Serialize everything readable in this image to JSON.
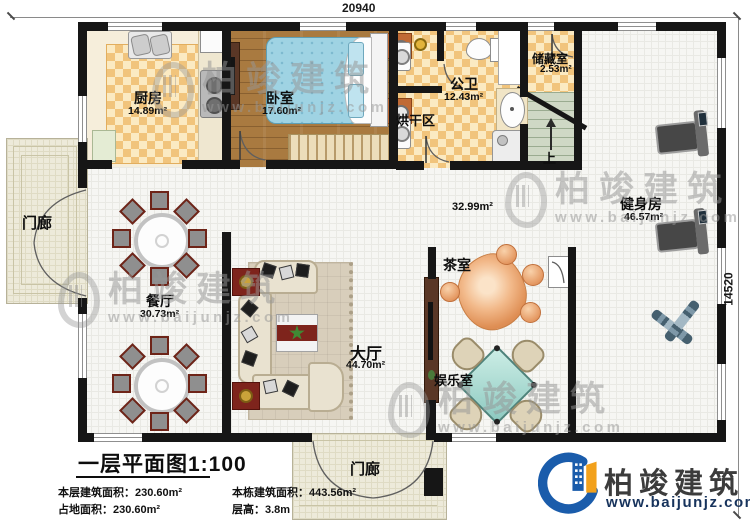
{
  "dimensions": {
    "top": "20940",
    "right": "14520"
  },
  "rooms": {
    "kitchen": {
      "label": "厨房",
      "area": "14.89m²"
    },
    "bedroom": {
      "label": "卧室",
      "area": "17.60m²"
    },
    "bathroom": {
      "label": "公卫",
      "area": "12.43m²"
    },
    "storage": {
      "label": "储藏室",
      "area": "2.53m²"
    },
    "drying": {
      "label": "烘干区"
    },
    "stairs": {
      "label": "上"
    },
    "gym": {
      "label": "健身房",
      "area": "46.57m²"
    },
    "corridor": {
      "area": "32.99m²"
    },
    "dining": {
      "label": "餐厅",
      "area": "30.73m²"
    },
    "hall": {
      "label": "大厅",
      "area": "44.70m²"
    },
    "tea": {
      "label": "茶室"
    },
    "game": {
      "label": "娱乐室"
    },
    "porch_left": {
      "label": "门廊"
    },
    "porch_bottom": {
      "label": "门廊"
    }
  },
  "footer": {
    "title": "一层平面图1:100",
    "floor_area_label": "本层建筑面积：",
    "floor_area": "230.60m²",
    "building_area_label": "本栋建筑面积：",
    "building_area": "443.56m²",
    "land_area_label": "占地面积：",
    "land_area": "230.60m²",
    "height_label": "层高：",
    "height": "3.8m"
  },
  "brand": {
    "name": "柏竣建筑",
    "url": "www.baijunjz.com"
  },
  "watermark": {
    "name": "柏竣建筑",
    "url": "www.baijunjz.com"
  },
  "colors": {
    "wall": "#161616",
    "logo_blue": "#1a5cab",
    "logo_orange": "#f2a11c",
    "url_navy": "#17335c",
    "checker": "#f1c47c",
    "wood": "#a97a40",
    "stairs": "#cfd8c5",
    "mahjong_teal": "#9ed5cc",
    "tea_wood": "#e8a26e"
  }
}
